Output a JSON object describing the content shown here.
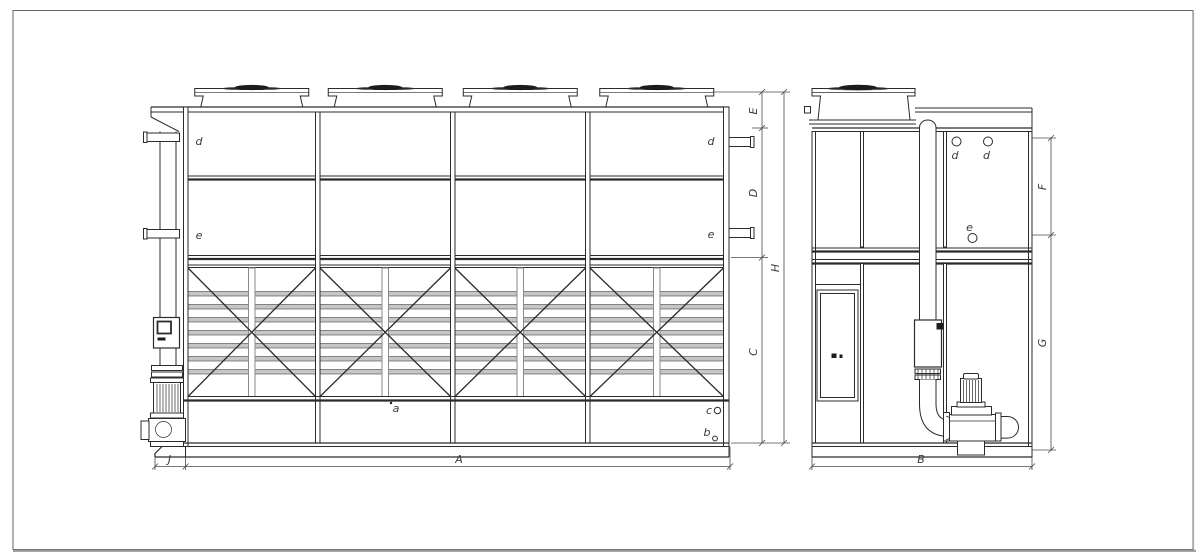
{
  "front_view": {
    "connections": {
      "d_left": "d",
      "d_right": "d",
      "e_left": "e",
      "e_right": "e"
    },
    "basin_labels": {
      "a": "a",
      "b": "b",
      "c": "c"
    },
    "dims": {
      "E": "E",
      "D": "D",
      "C": "C",
      "H": "H",
      "J": "J",
      "A": "A"
    }
  },
  "side_view": {
    "connections": {
      "d1": "d",
      "d2": "d",
      "e": "e"
    },
    "dims": {
      "F": "F",
      "G": "G",
      "B": "B"
    }
  },
  "colors": {
    "line": "#2b2b2b",
    "dim": "#4a4a4a",
    "slat_fill": "#c6c6c6",
    "dark_fill": "#1c1c1c",
    "background": "#ffffff",
    "border": "#666666"
  }
}
